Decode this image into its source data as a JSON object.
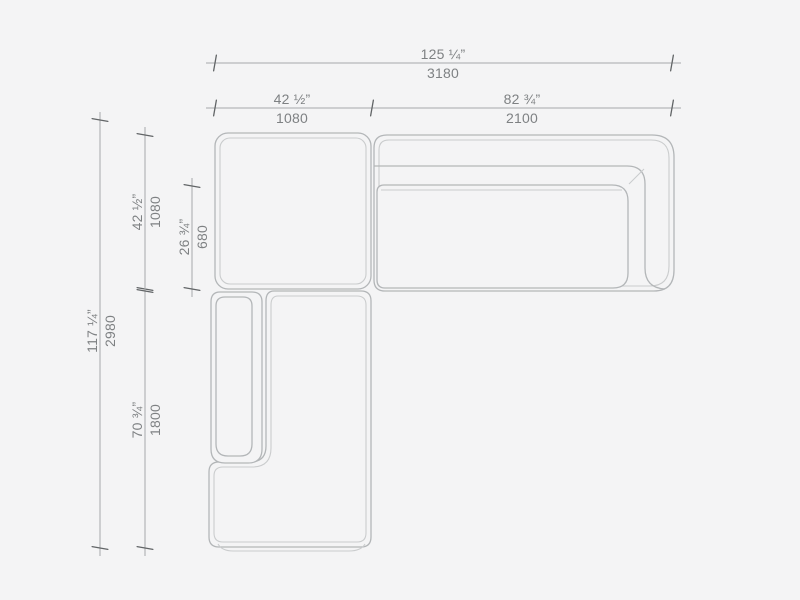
{
  "canvas": {
    "background": "#f4f4f5",
    "outline_color": "#b3b6b8",
    "inner_line_color": "#cacccd",
    "dimension_line_color": "#a6a8aa",
    "tick_color": "#626567",
    "label_color": "#7e8183"
  },
  "drawing": {
    "description": "Top-view plan drawing of a modular corner sofa with chaise, annotated with dimension lines",
    "modules": [
      "corner-module",
      "sofa-module-with-right-armrest",
      "left-armrest-module",
      "chaise-module"
    ]
  },
  "dims": {
    "total_width": {
      "inches": "125 ¼”",
      "mm": "3180"
    },
    "left_width": {
      "inches": "42 ½”",
      "mm": "1080"
    },
    "right_width": {
      "inches": "82 ¾”",
      "mm": "2100"
    },
    "total_depth": {
      "inches": "117 ¼”",
      "mm": "2980"
    },
    "corner_depth": {
      "inches": "42 ½”",
      "mm": "1080"
    },
    "seat_depth": {
      "inches": "26 ¾”",
      "mm": "680"
    },
    "chaise_length": {
      "inches": "70 ¾”",
      "mm": "1800"
    }
  }
}
